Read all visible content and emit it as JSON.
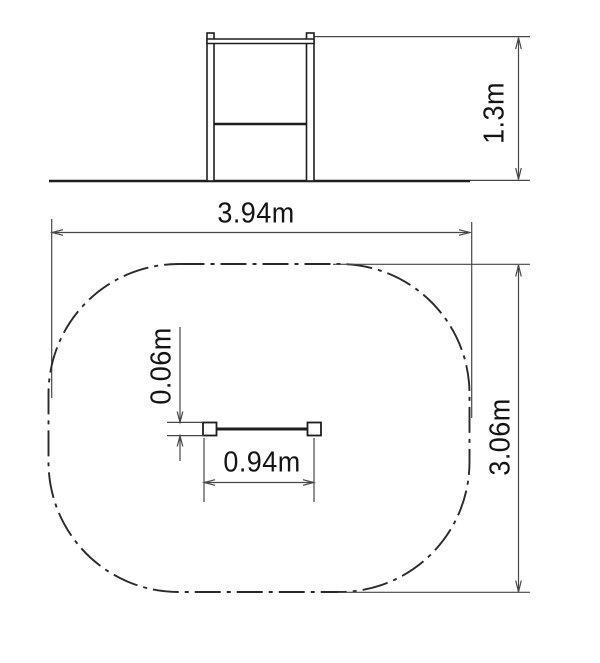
{
  "drawing": {
    "elevation_view": {
      "height_dimension": "1.3m"
    },
    "plan_view": {
      "zone_width_dimension": "3.94m",
      "zone_depth_dimension": "3.06m",
      "bar_length_dimension": "0.94m",
      "bar_thickness_dimension": "0.06m"
    },
    "colors": {
      "background": "#ffffff",
      "structure_line": "#1e1e1e",
      "dimension_line": "#474747",
      "zone_outline": "#2a2a2a",
      "text": "#141414"
    }
  }
}
